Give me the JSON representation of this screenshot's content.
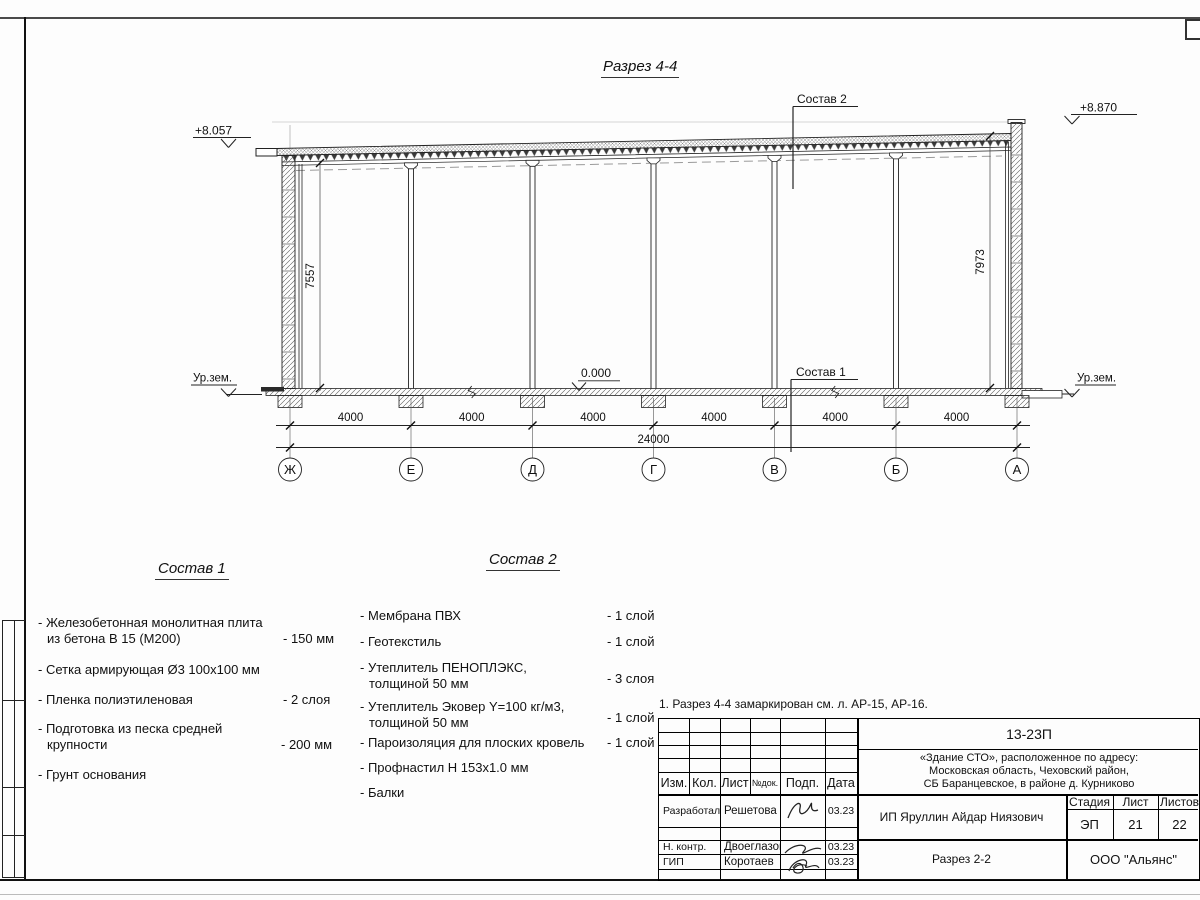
{
  "sheet": {
    "title": "Разрез 4-4"
  },
  "marks": {
    "elev_left": "+8.057",
    "elev_right": "+8.870",
    "ground_left": "Ур.зем.",
    "ground_right": "Ур.зем.",
    "zero": "0.000",
    "h_left": "7557",
    "h_right": "7973",
    "leader_roof": "Состав 2",
    "leader_floor": "Состав 1"
  },
  "dims": {
    "bays": [
      "4000",
      "4000",
      "4000",
      "4000",
      "4000",
      "4000"
    ],
    "total": "24000"
  },
  "axes": [
    "Ж",
    "Е",
    "Д",
    "Г",
    "В",
    "Б",
    "А"
  ],
  "sostav1": {
    "title": "Состав 1",
    "items": [
      {
        "l1": "- Железобетонная  монолитная плита",
        "l2": "из бетона В 15 (М200)",
        "v": "- 150 мм"
      },
      {
        "l1": "- Сетка армирующая Ø3 100х100 мм",
        "l2": "",
        "v": ""
      },
      {
        "l1": "- Пленка полиэтиленовая",
        "l2": "",
        "v": "-  2 слоя"
      },
      {
        "l1": "- Подготовка из песка средней",
        "l2": "крупности",
        "v": "- 200 мм"
      },
      {
        "l1": "- Грунт основания",
        "l2": "",
        "v": ""
      }
    ]
  },
  "sostav2": {
    "title": "Состав 2",
    "items": [
      {
        "l1": "- Мембрана ПВХ",
        "l2": "",
        "v": "- 1 слой"
      },
      {
        "l1": "- Геотекстиль",
        "l2": "",
        "v": "- 1 слой"
      },
      {
        "l1": "- Утеплитель ПЕНОПЛЭКС,",
        "l2": "толщиной 50 мм",
        "v": "- 3 слоя"
      },
      {
        "l1": "- Утеплитель Эковер Y=100 кг/м3,",
        "l2": "толщиной 50 мм",
        "v": "- 1 слой"
      },
      {
        "l1": "- Пароизоляция для плоских кровель",
        "l2": "",
        "v": "- 1 слой"
      },
      {
        "l1": "- Профнастил Н 153х1.0 мм",
        "l2": "",
        "v": ""
      },
      {
        "l1": "- Балки",
        "l2": "",
        "v": ""
      }
    ]
  },
  "note": "1. Разрез 4-4 замаркирован см. л. АР-15, АР-16.",
  "titleblock": {
    "doc": "13-23П",
    "project1": "«Здание СТО», расположенное по адресу:",
    "project2": "Московская область, Чеховский район,",
    "project3": "СБ Баранцевское, в районе д. Курниково",
    "cols": {
      "izm": "Изм.",
      "kol": "Кол.",
      "list": "Лист",
      "ndok": "№док.",
      "podp": "Подп.",
      "data": "Дата"
    },
    "rows": [
      {
        "role": "Разработал",
        "name": "Решетова",
        "date": "03.23"
      },
      {
        "role": "Н. контр.",
        "name": "Двоеглазов",
        "date": "03.23"
      },
      {
        "role": "ГИП",
        "name": "Коротаев",
        "date": "03.23"
      }
    ],
    "client": "ИП Яруллин Айдар Ниязович",
    "stage_label": "Стадия",
    "list_label": "Лист",
    "listov_label": "Листов",
    "stage": "ЭП",
    "list": "21",
    "listov": "22",
    "drawing": "Разрез 2-2",
    "company": "ООО \"Альянс\""
  }
}
